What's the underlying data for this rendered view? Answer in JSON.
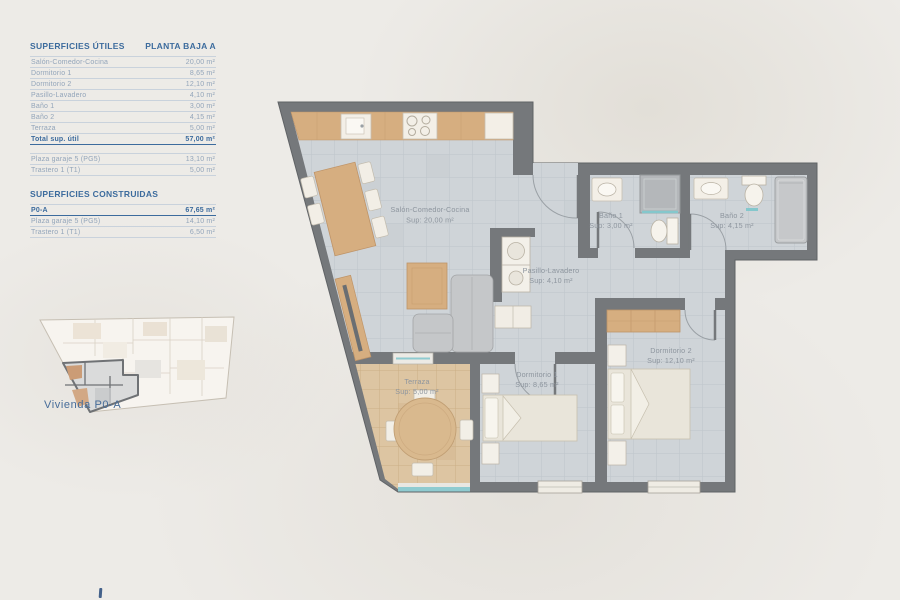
{
  "left_panel": {
    "utiles": {
      "title": "SUPERFICIES ÚTILES",
      "subtitle": "PLANTA BAJA A",
      "rows": [
        {
          "label": "Salón-Comedor-Cocina",
          "value": "20,00 m²"
        },
        {
          "label": "Dormitorio 1",
          "value": "8,65 m²"
        },
        {
          "label": "Dormitorio 2",
          "value": "12,10 m²"
        },
        {
          "label": "Pasillo-Lavadero",
          "value": "4,10 m²"
        },
        {
          "label": "Baño 1",
          "value": "3,00 m²"
        },
        {
          "label": "Baño 2",
          "value": "4,15 m²"
        },
        {
          "label": "Terraza",
          "value": "5,00 m²"
        }
      ],
      "total": {
        "label": "Total sup. útil",
        "value": "57,00 m²"
      },
      "extras": [
        {
          "label": "Plaza garaje 5 (PG5)",
          "value": "13,10 m²"
        },
        {
          "label": "Trastero 1 (T1)",
          "value": "5,00 m²"
        }
      ]
    },
    "construidas": {
      "title": "SUPERFICIES CONSTRUIDAS",
      "rows": [
        {
          "label": "P0-A",
          "value": "67,65 m²"
        },
        {
          "label": "Plaza garaje 5 (PG5)",
          "value": "14,10 m²"
        },
        {
          "label": "Trastero 1 (T1)",
          "value": "6,50 m²"
        }
      ]
    },
    "mini_plan_caption": "Vivienda P0-A"
  },
  "plan": {
    "rooms": [
      {
        "name": "Salón-Comedor-Cocina",
        "sup": "Sup: 20,00 m²"
      },
      {
        "name": "Baño 1",
        "sup": "Sup: 3,00 m²"
      },
      {
        "name": "Baño 2",
        "sup": "Sup: 4,15 m²"
      },
      {
        "name": "Pasillo-Lavadero",
        "sup": "Sup: 4,10 m²"
      },
      {
        "name": "Dormitorio 1",
        "sup": "Sup: 8,65 m²"
      },
      {
        "name": "Dormitorio 2",
        "sup": "Sup: 12,10 m²"
      },
      {
        "name": "Terraza",
        "sup": "Sup: 5,00 m²"
      }
    ]
  },
  "colors": {
    "accent_blue": "#3c6b9d",
    "table_text": "#93a5ba",
    "wall_gray": "#75787b",
    "floor_tile": "#cfd4d8",
    "terrace_tile": "#ddc5a2",
    "wood": "#d6ae80",
    "glass_teal": "#8fcbd0",
    "plan_label_gray": "#8d959e"
  }
}
